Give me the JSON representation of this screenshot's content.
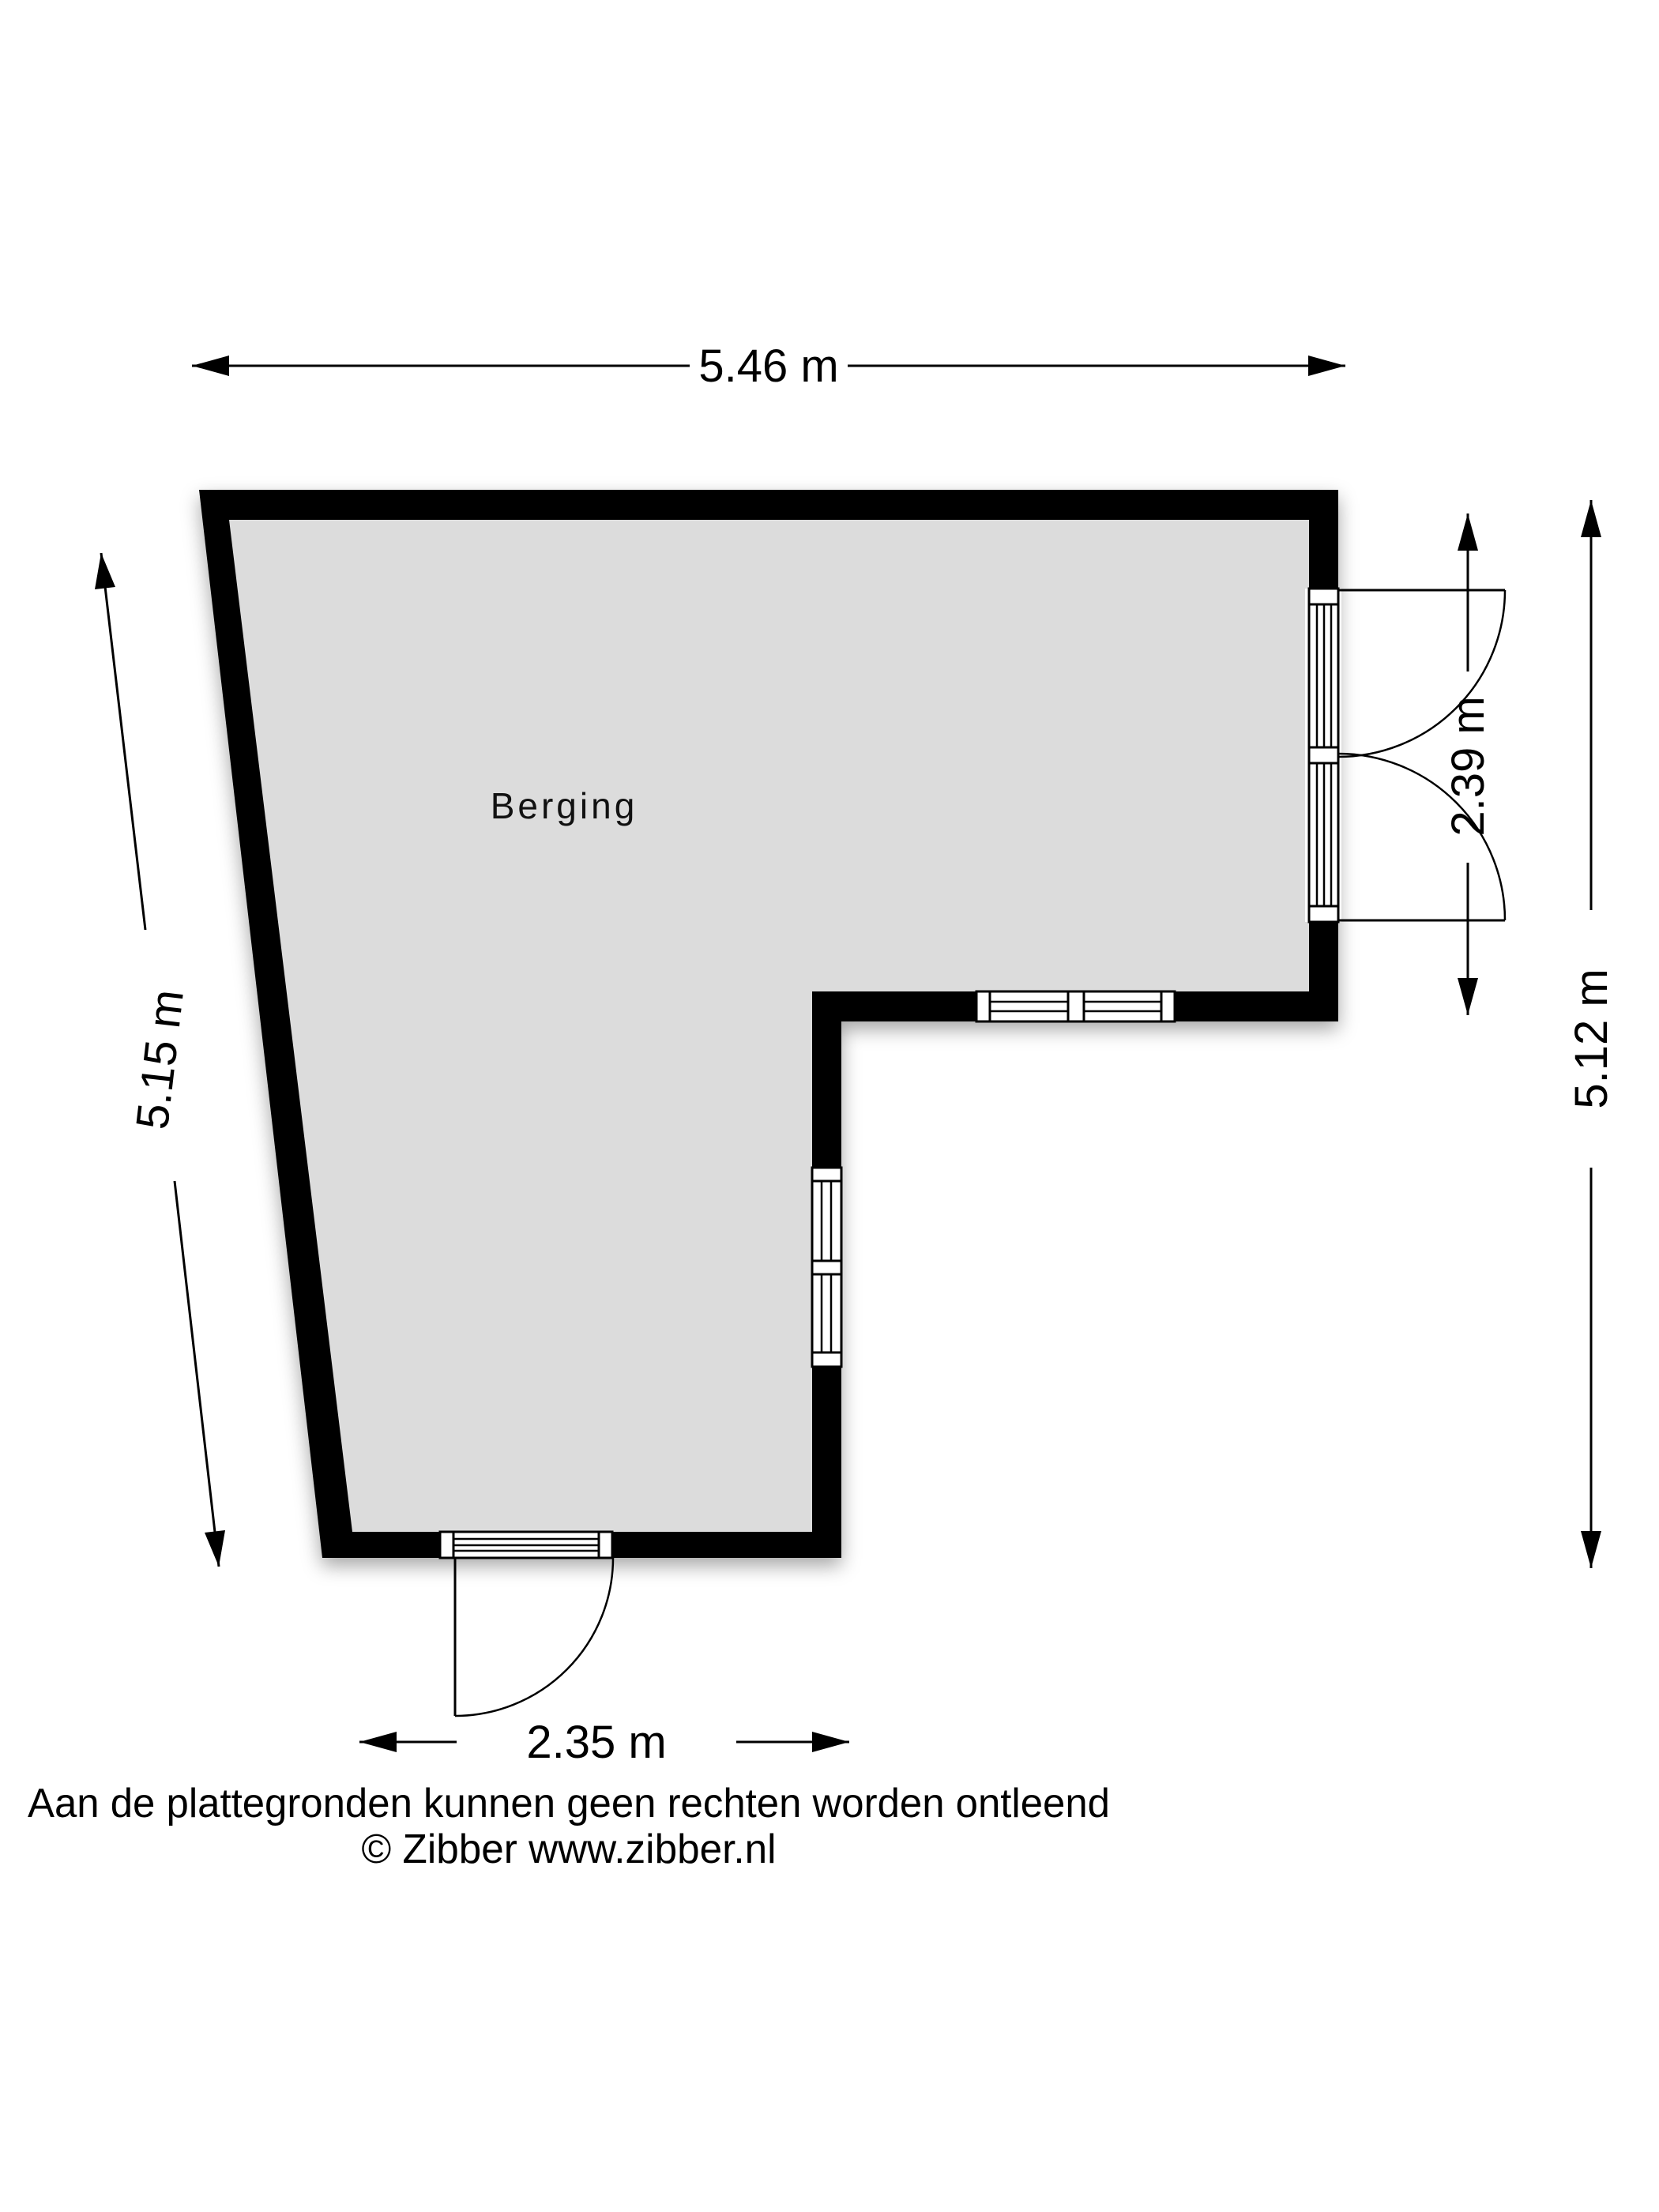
{
  "plan": {
    "room_label": "Berging",
    "dimensions": {
      "top": "5.46 m",
      "left": "5.15 m",
      "right_inner": "2.39 m",
      "right_outer": "5.12 m",
      "bottom": "2.35 m"
    },
    "colors": {
      "wall": "#000000",
      "floor": "#dcdcdc",
      "background": "#ffffff"
    }
  },
  "footer": {
    "disclaimer": "Aan de plattegronden kunnen geen rechten worden ontleend",
    "copyright": "© Zibber www.zibber.nl"
  }
}
